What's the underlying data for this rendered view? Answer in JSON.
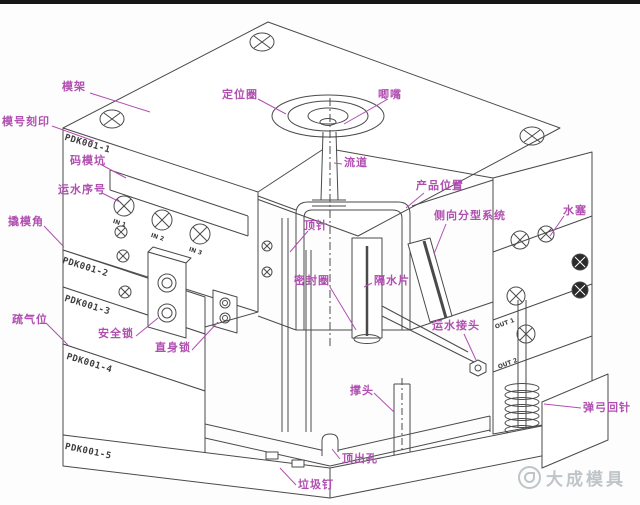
{
  "page": {
    "background": "#ffffff",
    "top_bar_color": "#161616"
  },
  "colors": {
    "label": "#b14fb1",
    "line": "#4a4a4a",
    "watermark": "#8d979e"
  },
  "labels": [
    {
      "id": "mold-base",
      "text": "模架"
    },
    {
      "id": "mold-number-engraving",
      "text": "模号刻印"
    },
    {
      "id": "clamp-slot",
      "text": "码模坑"
    },
    {
      "id": "water-line-number",
      "text": "运水序号"
    },
    {
      "id": "pry-corner",
      "text": "撬模角"
    },
    {
      "id": "vent-slot",
      "text": "疏气位"
    },
    {
      "id": "safety-lock",
      "text": "安全锁"
    },
    {
      "id": "straight-lock",
      "text": "直身锁"
    },
    {
      "id": "locating-ring",
      "text": "定位圈"
    },
    {
      "id": "sprue-bushing",
      "text": "唧嘴"
    },
    {
      "id": "runner",
      "text": "流道"
    },
    {
      "id": "product-position",
      "text": "产品位置"
    },
    {
      "id": "side-parting-system",
      "text": "侧向分型系统"
    },
    {
      "id": "water-plug",
      "text": "水塞"
    },
    {
      "id": "ejector-pin",
      "text": "顶针"
    },
    {
      "id": "seal-ring",
      "text": "密封圈"
    },
    {
      "id": "water-baffle",
      "text": "隔水片"
    },
    {
      "id": "water-connector",
      "text": "运水接头"
    },
    {
      "id": "support-pillar",
      "text": "撑头"
    },
    {
      "id": "spring-return-pin",
      "text": "弹弓回针"
    },
    {
      "id": "ejection-hole",
      "text": "顶出孔"
    },
    {
      "id": "stop-pin",
      "text": "垃圾钉"
    }
  ],
  "plate_codes": [
    "PDK001-1",
    "PDK001-2",
    "PDK001-3",
    "PDK001-4",
    "PDK001-5"
  ],
  "port_labels": [
    "IN 1",
    "IN 2",
    "IN 3",
    "OUT 1",
    "OUT 2"
  ],
  "watermark": {
    "text": "大成模具"
  }
}
